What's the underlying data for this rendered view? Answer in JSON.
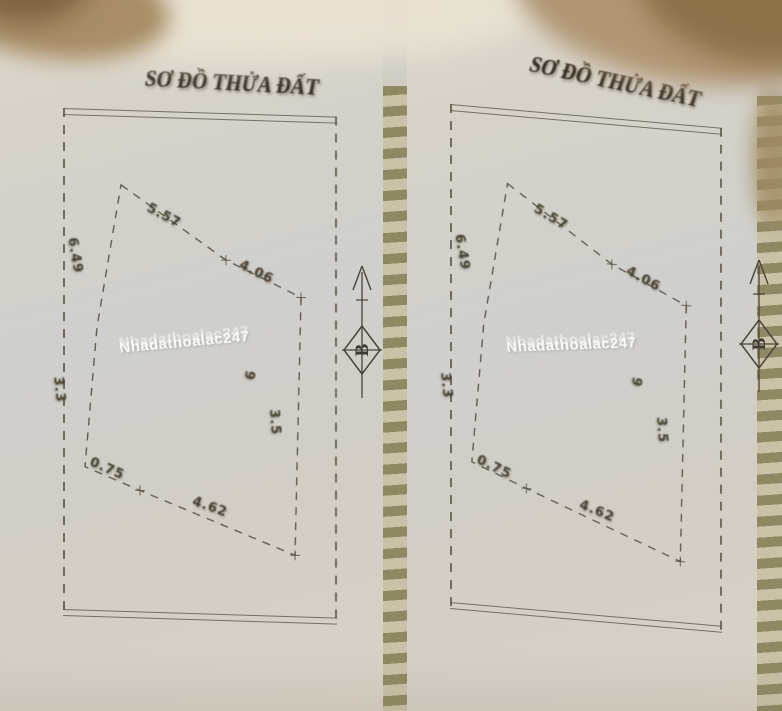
{
  "pages": [
    {
      "title": "SƠ ĐỒ THỬA ĐẤT",
      "watermark": "Nhadathoalac247",
      "north_label": "B",
      "labels": [
        {
          "text": "5.57",
          "x": 88,
          "y": 90,
          "rot": 27
        },
        {
          "text": "4.06",
          "x": 180,
          "y": 144,
          "rot": 25
        },
        {
          "text": "6.49",
          "x": 16,
          "y": 128,
          "rot": 80
        },
        {
          "text": "3.3",
          "x": 2,
          "y": 268,
          "rot": 84
        },
        {
          "text": "0.75",
          "x": 30,
          "y": 346,
          "rot": 22
        },
        {
          "text": "4.62",
          "x": 132,
          "y": 382,
          "rot": 18
        },
        {
          "text": "3.5",
          "x": 218,
          "y": 294,
          "rot": 86
        },
        {
          "text": "9",
          "x": 194,
          "y": 258,
          "rot": 100
        }
      ]
    },
    {
      "title": "SƠ ĐỒ THỬA ĐẤT",
      "watermark": "Nhadathoalac247",
      "north_label": "B",
      "labels": [
        {
          "text": "5.57",
          "x": 88,
          "y": 90,
          "rot": 27
        },
        {
          "text": "4.06",
          "x": 180,
          "y": 144,
          "rot": 25
        },
        {
          "text": "6.49",
          "x": 16,
          "y": 128,
          "rot": 80
        },
        {
          "text": "3.3",
          "x": 2,
          "y": 268,
          "rot": 84
        },
        {
          "text": "0.75",
          "x": 30,
          "y": 346,
          "rot": 22
        },
        {
          "text": "4.62",
          "x": 132,
          "y": 382,
          "rot": 18
        },
        {
          "text": "3.5",
          "x": 218,
          "y": 294,
          "rot": 86
        },
        {
          "text": "9",
          "x": 194,
          "y": 258,
          "rot": 100
        }
      ]
    }
  ]
}
